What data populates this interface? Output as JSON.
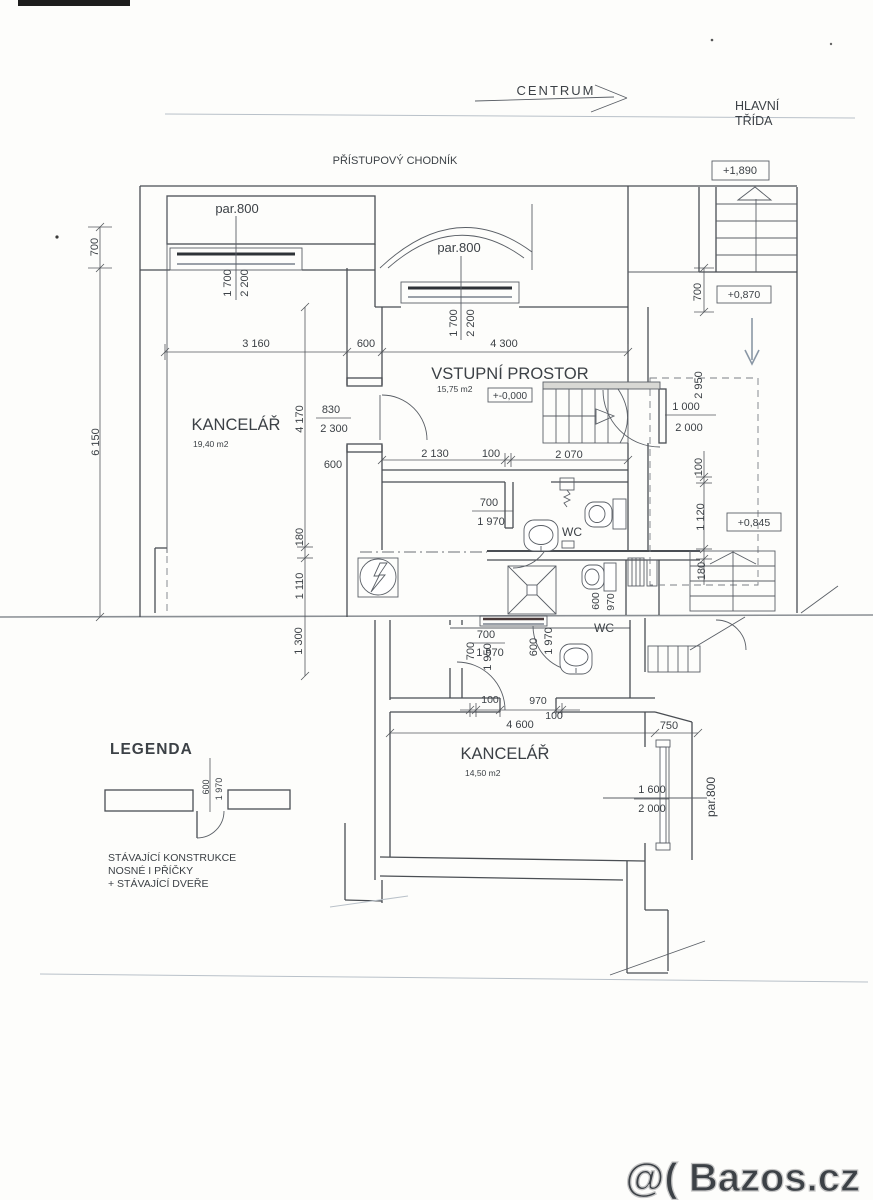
{
  "street": {
    "centrum": "CENTRUM",
    "hlavni_1": "HLAVNÍ",
    "hlavni_2": "TŘÍDA",
    "chodnik": "PŘÍSTUPOVÝ CHODNÍK"
  },
  "levels": {
    "top": "+1,890",
    "mid": "+0,870",
    "zero": "+-0,000",
    "low": "+0,845"
  },
  "windows": {
    "par800_a": "par.800",
    "par800_b": "par.800",
    "par800_c": "par.800"
  },
  "rooms": {
    "kancelar1_name": "KANCELÁŘ",
    "kancelar1_area": "19,40 m2",
    "vstupni_name": "VSTUPNÍ PROSTOR",
    "vstupni_area": "15,75 m2",
    "wc1": "WC",
    "wc2": "WC",
    "kancelar2_name": "KANCELÁŘ",
    "kancelar2_area": "14,50 m2"
  },
  "dims": {
    "d700_left": "700",
    "d6150": "6 150",
    "w1_1700": "1 700",
    "w1_2200": "2 200",
    "w2_1700": "1 700",
    "w2_2200": "2 200",
    "d3160": "3 160",
    "d600_top": "600",
    "d4300": "4 300",
    "d4170": "4 170",
    "d180_mid": "180",
    "d1110": "1 110",
    "d1300": "1 300",
    "door1_830": "830",
    "door1_2300": "2 300",
    "door1_600": "600",
    "d2130": "2 130",
    "d100_entry": "100",
    "d2070": "2 070",
    "wcdoor_700": "700",
    "wcdoor_1970": "1 970",
    "d700_right": "700",
    "d2950": "2 950",
    "door2_1000": "1 000",
    "door2_2000": "2 000",
    "d100_right": "100",
    "d1120": "1 120",
    "d180_right": "180",
    "d600_shaft": "600",
    "d970_shaft": "970",
    "lw_700h": "700",
    "lw_1970h": "1 970",
    "lw_700v": "700",
    "lw_1950v": "1 950",
    "lw_600v": "600",
    "lw_1970v": "1 970",
    "d100_a": "100",
    "d970": "970",
    "d100_b": "100",
    "d4600": "4 600",
    "d750": "750",
    "lwin_1600": "1 600",
    "lwin_2000": "2 000"
  },
  "legend": {
    "title": "LEGENDA",
    "d600": "600",
    "d1970": "1 970",
    "line1": "STÁVAJÍCÍ KONSTRUKCE",
    "line2": "NOSNÉ I PŘÍČKY",
    "line3": "+ STÁVAJÍCÍ DVEŘE"
  },
  "watermark": "@( Bazos.cz"
}
